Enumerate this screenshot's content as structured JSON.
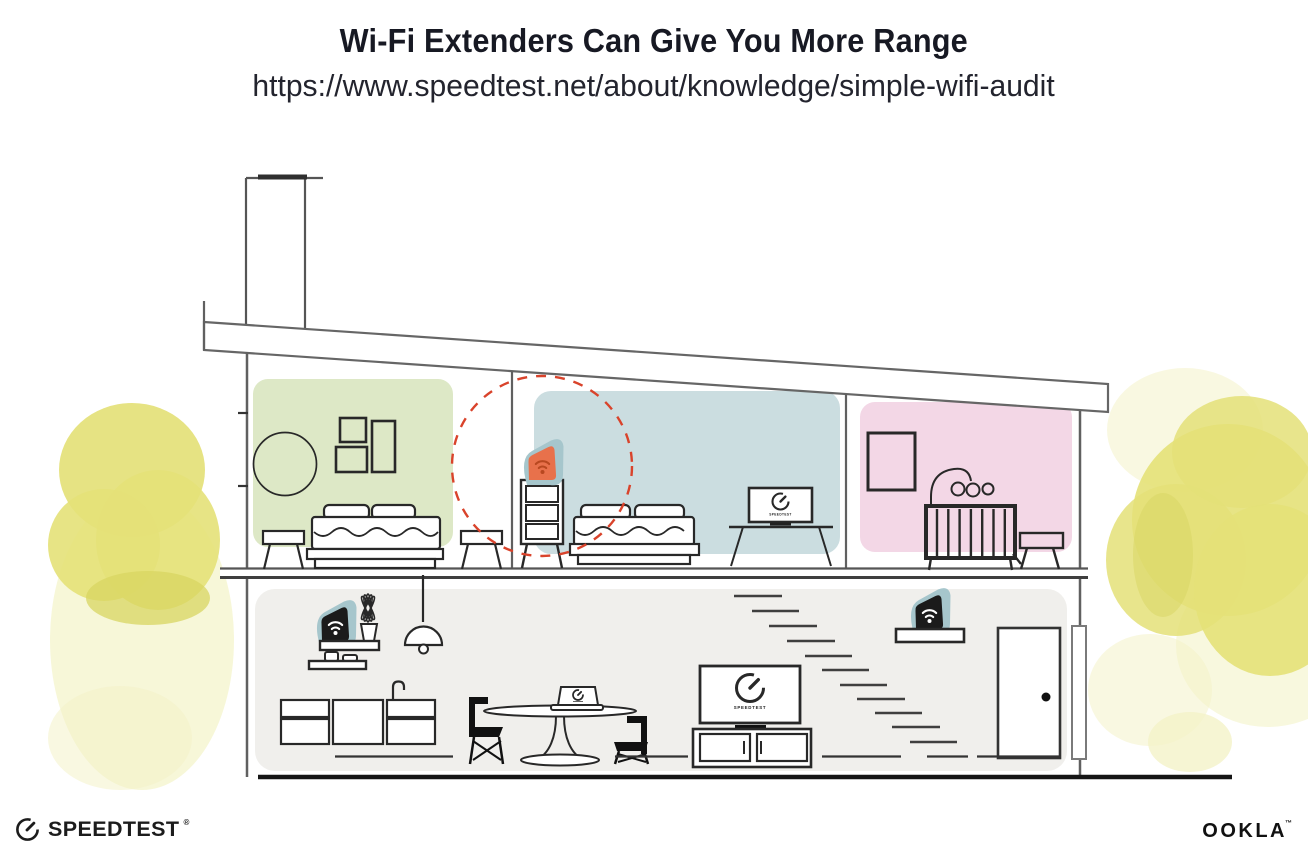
{
  "header": {
    "title": "Wi-Fi Extenders Can Give You More Range",
    "url": "https://www.speedtest.net/about/knowledge/simple-wifi-audit"
  },
  "illustration": {
    "living_room_tv_label": "SPEEDTEST",
    "bedroom_tv_label": "SPEEDTEST"
  },
  "footer": {
    "speedtest_wordmark": "SPEEDTEST",
    "speedtest_reg_mark": "®",
    "ookla_wordmark": "OOKLA",
    "ookla_trade_mark": "™"
  },
  "icons": {
    "wifi_device": "wifi-icon",
    "speed_gauge": "gauge-icon",
    "signal_range": "dashed-circle-icon"
  },
  "colors": {
    "title_text": "#171923",
    "url_text": "#23242e",
    "room_green": "#dde8c6",
    "room_blue": "#cbdde0",
    "room_pink": "#f3d7e6",
    "room_lower": "#f0efec",
    "device_teal": "#a6c6cc",
    "extender_orange": "#e8714b",
    "extender_icon": "#b84820",
    "signal_dashed": "#d9432b",
    "foliage_yellow": "#e4e178",
    "foliage_wash": "#f4f3c8",
    "foliage_dark": "#d8d562",
    "line_dark": "#282828",
    "line_wall": "#606060"
  }
}
